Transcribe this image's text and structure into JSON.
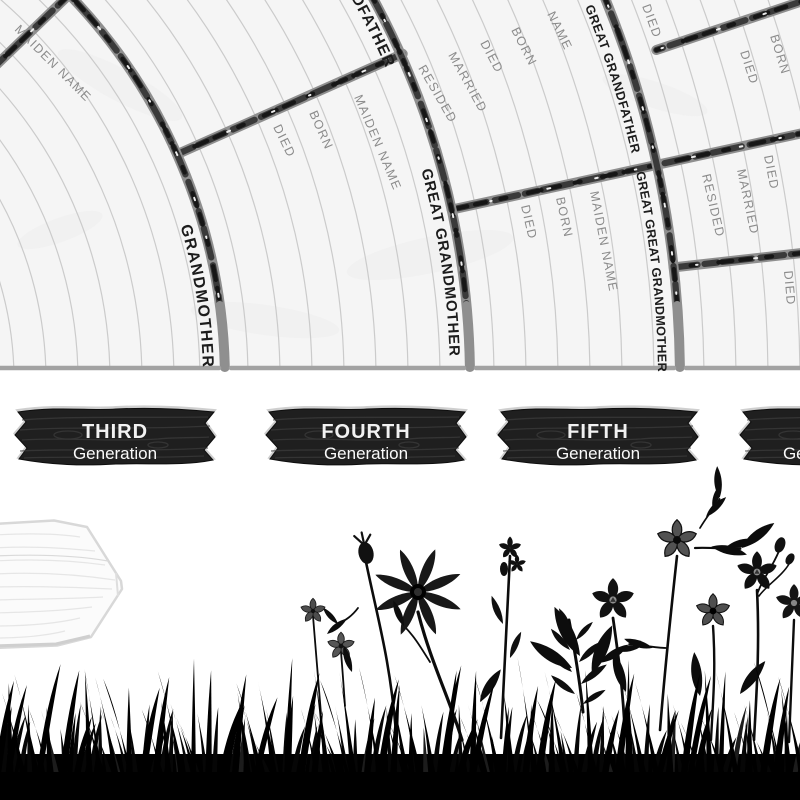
{
  "poster": {
    "type": "genealogy-fan-chart",
    "colors": {
      "paper": "#f5f5f5",
      "ruled_line": "#cbcbcb",
      "branch_outline": "#8f8f8f",
      "branch_dark": "#1a1a1a",
      "branch_speck": "#ededed",
      "border": "#a2a2a2",
      "field_text": "#8b8b8b",
      "sector_text": "#1c1c1c",
      "plaque_wood": "#1f1f1f",
      "plaque_text": "#f2f2f2",
      "silhouette": "#060606",
      "sign_wood": "#fbfbfb"
    }
  },
  "chart": {
    "sector_labels": [
      {
        "id": "grandmother",
        "text": "GRANDMOTHER"
      },
      {
        "id": "great-grandfather",
        "text": "GREAT GRANDFATHER"
      },
      {
        "id": "great-grandmother",
        "text": "GREAT GRANDMOTHER"
      },
      {
        "id": "great-great-grandfather",
        "text": "GREAT GREAT GRANDFATHER"
      },
      {
        "id": "great-great-grandmother",
        "text": "GREAT GREAT GRANDMOTHER"
      }
    ],
    "field_labels": [
      {
        "text": "MAIDEN NAME",
        "x": 14,
        "y": 30,
        "rot": 45
      },
      {
        "text": "MAIDEN NAME",
        "x": 354,
        "y": 97,
        "rot": 67
      },
      {
        "text": "BORN",
        "x": 309,
        "y": 113,
        "rot": 66
      },
      {
        "text": "DIED",
        "x": 273,
        "y": 127,
        "rot": 64
      },
      {
        "text": "NAME",
        "x": 547,
        "y": 14,
        "rot": 64
      },
      {
        "text": "BORN",
        "x": 511,
        "y": 30,
        "rot": 63
      },
      {
        "text": "DIED",
        "x": 480,
        "y": 43,
        "rot": 62
      },
      {
        "text": "MARRIED",
        "x": 448,
        "y": 55,
        "rot": 61
      },
      {
        "text": "RESIDED",
        "x": 418,
        "y": 68,
        "rot": 60
      },
      {
        "text": "MAIDEN NAME",
        "x": 590,
        "y": 192,
        "rot": 79
      },
      {
        "text": "BORN",
        "x": 556,
        "y": 198,
        "rot": 78
      },
      {
        "text": "DIED",
        "x": 521,
        "y": 206,
        "rot": 77
      },
      {
        "text": "DIED",
        "x": 642,
        "y": 6,
        "rot": 70
      },
      {
        "text": "BORN",
        "x": 770,
        "y": 36,
        "rot": 73
      },
      {
        "text": "DIED",
        "x": 740,
        "y": 52,
        "rot": 72
      },
      {
        "text": "DIED",
        "x": 764,
        "y": 156,
        "rot": 79
      },
      {
        "text": "MARRIED",
        "x": 737,
        "y": 170,
        "rot": 78
      },
      {
        "text": "RESIDED",
        "x": 702,
        "y": 175,
        "rot": 77
      },
      {
        "text": "DIED",
        "x": 784,
        "y": 271,
        "rot": 85
      }
    ]
  },
  "plaques": [
    {
      "title": "THIRD",
      "subtitle": "Generation"
    },
    {
      "title": "FOURTH",
      "subtitle": "Generation"
    },
    {
      "title": "FIFTH",
      "subtitle": "Generation"
    },
    {
      "title": "",
      "subtitle": "Generation"
    }
  ]
}
